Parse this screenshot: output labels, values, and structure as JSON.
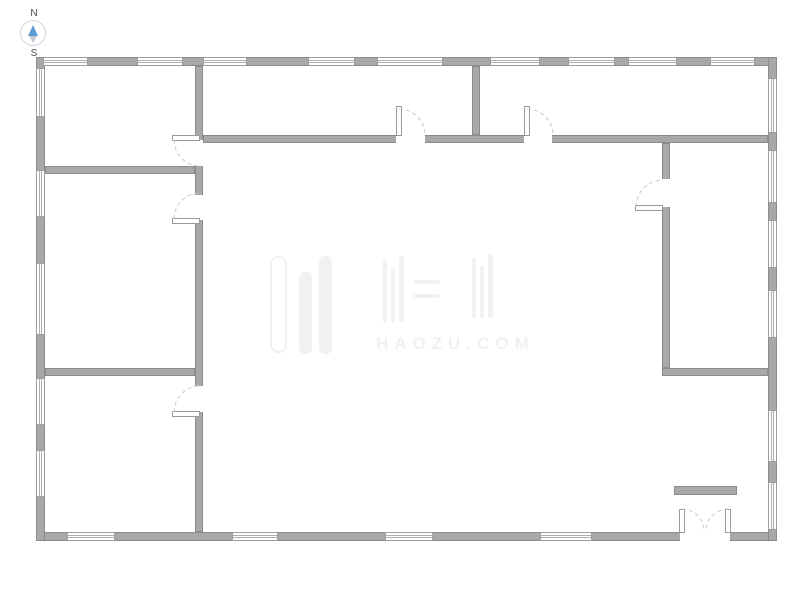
{
  "compass": {
    "north_label": "N",
    "south_label": "S"
  },
  "watermark": {
    "text": "HAOZU.COM"
  },
  "colors": {
    "wall_fill": "#a8a8a8",
    "wall_border": "#8b8b8b",
    "window_line": "#b0b0b0",
    "arc": "#c9c9c9",
    "compass_needle": "#5b9bd5",
    "compass_tail": "#c3c9d0",
    "watermark": "#f1f1f1"
  },
  "plan": {
    "walls": [
      {
        "name": "wall-exterior-top",
        "x": 36,
        "y": 57,
        "w": 741,
        "h": 9
      },
      {
        "name": "wall-exterior-bottom",
        "x": 36,
        "y": 532,
        "w": 741,
        "h": 9
      },
      {
        "name": "wall-exterior-left",
        "x": 36,
        "y": 57,
        "w": 9,
        "h": 484
      },
      {
        "name": "wall-exterior-right",
        "x": 768,
        "y": 57,
        "w": 9,
        "h": 484
      },
      {
        "name": "wall-interior-v1",
        "x": 195,
        "y": 66,
        "w": 8,
        "h": 466
      },
      {
        "name": "wall-interior-h1",
        "x": 45,
        "y": 166,
        "w": 150,
        "h": 8
      },
      {
        "name": "wall-interior-h2",
        "x": 45,
        "y": 368,
        "w": 150,
        "h": 8
      },
      {
        "name": "wall-interior-h3",
        "x": 203,
        "y": 135,
        "w": 565,
        "h": 8
      },
      {
        "name": "wall-interior-v2",
        "x": 472,
        "y": 66,
        "w": 8,
        "h": 69
      },
      {
        "name": "wall-interior-v3",
        "x": 662,
        "y": 143,
        "w": 8,
        "h": 225
      },
      {
        "name": "wall-interior-h4",
        "x": 662,
        "y": 368,
        "w": 106,
        "h": 8
      },
      {
        "name": "counter-partition",
        "x": 674,
        "y": 486,
        "w": 63,
        "h": 9
      }
    ],
    "windows": [
      {
        "name": "window-top-1",
        "x": 43,
        "y": 57,
        "w": 45,
        "h": 9,
        "orient": "h"
      },
      {
        "name": "window-top-2",
        "x": 137,
        "y": 57,
        "w": 46,
        "h": 9,
        "orient": "h"
      },
      {
        "name": "window-top-3",
        "x": 203,
        "y": 57,
        "w": 44,
        "h": 9,
        "orient": "h"
      },
      {
        "name": "window-top-4",
        "x": 308,
        "y": 57,
        "w": 47,
        "h": 9,
        "orient": "h"
      },
      {
        "name": "window-top-5",
        "x": 377,
        "y": 57,
        "w": 66,
        "h": 9,
        "orient": "h"
      },
      {
        "name": "window-top-6",
        "x": 490,
        "y": 57,
        "w": 50,
        "h": 9,
        "orient": "h"
      },
      {
        "name": "window-top-7",
        "x": 568,
        "y": 57,
        "w": 47,
        "h": 9,
        "orient": "h"
      },
      {
        "name": "window-top-8",
        "x": 628,
        "y": 57,
        "w": 49,
        "h": 9,
        "orient": "h"
      },
      {
        "name": "window-top-9",
        "x": 710,
        "y": 57,
        "w": 45,
        "h": 9,
        "orient": "h"
      },
      {
        "name": "window-left-1",
        "x": 36,
        "y": 68,
        "w": 9,
        "h": 49,
        "orient": "v"
      },
      {
        "name": "window-left-2",
        "x": 36,
        "y": 170,
        "w": 9,
        "h": 47,
        "orient": "v"
      },
      {
        "name": "window-left-3",
        "x": 36,
        "y": 263,
        "w": 9,
        "h": 72,
        "orient": "v"
      },
      {
        "name": "window-left-4",
        "x": 36,
        "y": 378,
        "w": 9,
        "h": 47,
        "orient": "v"
      },
      {
        "name": "window-left-5",
        "x": 36,
        "y": 450,
        "w": 9,
        "h": 47,
        "orient": "v"
      },
      {
        "name": "window-bottom-1",
        "x": 67,
        "y": 532,
        "w": 48,
        "h": 9,
        "orient": "h"
      },
      {
        "name": "window-bottom-2",
        "x": 232,
        "y": 532,
        "w": 46,
        "h": 9,
        "orient": "h"
      },
      {
        "name": "window-bottom-3",
        "x": 385,
        "y": 532,
        "w": 48,
        "h": 9,
        "orient": "h"
      },
      {
        "name": "window-bottom-4",
        "x": 540,
        "y": 532,
        "w": 52,
        "h": 9,
        "orient": "h"
      },
      {
        "name": "window-right-1",
        "x": 768,
        "y": 78,
        "w": 9,
        "h": 55,
        "orient": "v"
      },
      {
        "name": "window-right-2",
        "x": 768,
        "y": 150,
        "w": 9,
        "h": 53,
        "orient": "v"
      },
      {
        "name": "window-right-3",
        "x": 768,
        "y": 220,
        "w": 9,
        "h": 48,
        "orient": "v"
      },
      {
        "name": "window-right-4",
        "x": 768,
        "y": 290,
        "w": 9,
        "h": 48,
        "orient": "v"
      },
      {
        "name": "window-right-5",
        "x": 768,
        "y": 410,
        "w": 9,
        "h": 52,
        "orient": "v"
      },
      {
        "name": "window-right-6",
        "x": 768,
        "y": 482,
        "w": 9,
        "h": 48,
        "orient": "v"
      }
    ],
    "door_gaps": [
      {
        "name": "door-opening-room1",
        "x": 195,
        "y": 140,
        "w": 8,
        "h": 26
      },
      {
        "name": "door-opening-room2",
        "x": 195,
        "y": 195,
        "w": 8,
        "h": 25
      },
      {
        "name": "door-opening-room3",
        "x": 195,
        "y": 386,
        "w": 8,
        "h": 26
      },
      {
        "name": "door-opening-corridor",
        "x": 396,
        "y": 135,
        "w": 29,
        "h": 8
      },
      {
        "name": "door-opening-topright-room",
        "x": 524,
        "y": 135,
        "w": 28,
        "h": 8
      },
      {
        "name": "door-opening-right-room",
        "x": 662,
        "y": 179,
        "w": 8,
        "h": 28
      },
      {
        "name": "door-opening-entrance",
        "x": 680,
        "y": 532,
        "w": 50,
        "h": 9
      }
    ],
    "door_leaves": [
      {
        "name": "door-leaf-room1",
        "x": 172,
        "y": 135,
        "w": 28,
        "h": 6
      },
      {
        "name": "door-leaf-room2",
        "x": 172,
        "y": 218,
        "w": 28,
        "h": 6
      },
      {
        "name": "door-leaf-room3",
        "x": 172,
        "y": 411,
        "w": 28,
        "h": 6
      },
      {
        "name": "door-leaf-corridor",
        "x": 396,
        "y": 106,
        "w": 6,
        "h": 30
      },
      {
        "name": "door-leaf-topright-room",
        "x": 524,
        "y": 106,
        "w": 6,
        "h": 30
      },
      {
        "name": "door-leaf-right-room",
        "x": 635,
        "y": 205,
        "w": 28,
        "h": 6
      },
      {
        "name": "door-leaf-entrance-left",
        "x": 679,
        "y": 509,
        "w": 6,
        "h": 24
      },
      {
        "name": "door-leaf-entrance-right",
        "x": 725,
        "y": 509,
        "w": 6,
        "h": 24
      }
    ],
    "door_arcs": [
      {
        "name": "door-swing-room1",
        "path": "M174,140 A26,26 0 0 0 200,166"
      },
      {
        "name": "door-swing-room2",
        "path": "M174,219 A26,26 0 0 1 200,193"
      },
      {
        "name": "door-swing-room3",
        "path": "M174,412 A26,26 0 0 1 200,386"
      },
      {
        "name": "door-swing-corridor",
        "path": "M399,109 A26,26 0 0 1 425,135"
      },
      {
        "name": "door-swing-topright-room",
        "path": "M527,109 A26,26 0 0 1 553,135"
      },
      {
        "name": "door-swing-right-room",
        "path": "M636,207 A27,27 0 0 1 663,180"
      },
      {
        "name": "door-swing-entrance-left",
        "path": "M682,509 A22,22 0 0 1 704,531"
      },
      {
        "name": "door-swing-entrance-right",
        "path": "M728,509 A22,22 0 0 0 706,531"
      }
    ]
  }
}
